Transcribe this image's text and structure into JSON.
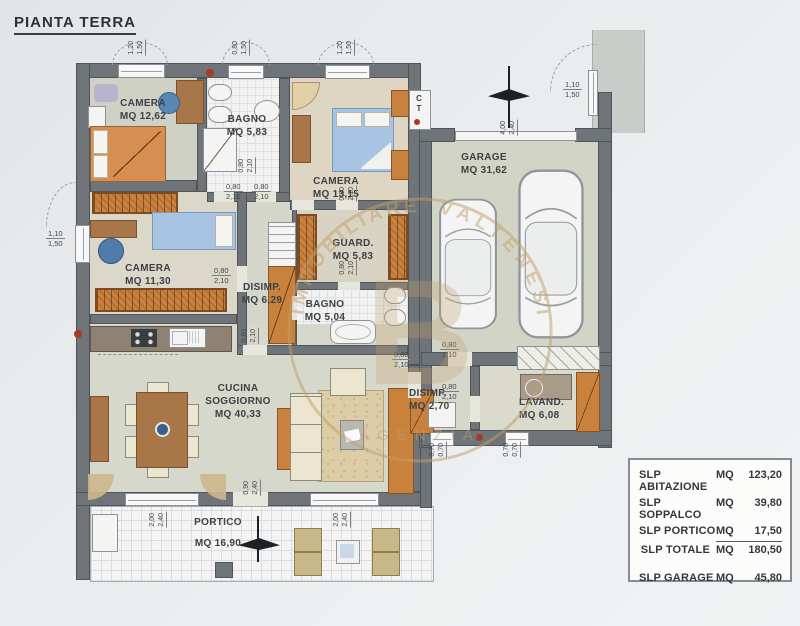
{
  "title": "PIANTA TERRA",
  "colors": {
    "wall": "#6f7478",
    "paper": "#e9ebec",
    "floor": "#d8d8ca",
    "furniture_orange": "#c8823e",
    "bed_blue": "#a9c3e2",
    "watermark_tan": "#c2a06c",
    "red_dot": "#a83a28"
  },
  "rooms": {
    "camera1": {
      "name": "CAMERA",
      "area": "MQ 12,62"
    },
    "bagno1": {
      "name": "BAGNO",
      "area": "MQ 5,83"
    },
    "camera2": {
      "name": "CAMERA",
      "area": "MQ 13,15"
    },
    "camera3": {
      "name": "CAMERA",
      "area": "MQ 11,30"
    },
    "guard": {
      "name": "GUARD.",
      "area": "MQ 5,83"
    },
    "disimp1": {
      "name": "DISIMP.",
      "area": "MQ 6,29"
    },
    "bagno2": {
      "name": "BAGNO",
      "area": "MQ 5,04"
    },
    "soggiorno": {
      "name1": "CUCINA",
      "name2": "SOGGIORNO",
      "area": "MQ 40,33"
    },
    "portico": {
      "name": "PORTICO",
      "area": "MQ 16,90"
    },
    "garage": {
      "name": "GARAGE",
      "area": "MQ 31,62"
    },
    "disimp2": {
      "name": "DISIMP.",
      "area": "MQ 2,70"
    },
    "lavand": {
      "name": "LAVAND.",
      "area": "MQ 6,08"
    }
  },
  "ct": {
    "c": "C",
    "t": "T"
  },
  "dims": [
    {
      "x": 127,
      "y": 40,
      "o": "v",
      "a": "1,20",
      "b": "1,50"
    },
    {
      "x": 231,
      "y": 40,
      "o": "v",
      "a": "0,80",
      "b": "1,50"
    },
    {
      "x": 336,
      "y": 40,
      "o": "v",
      "a": "1,20",
      "b": "1,50"
    },
    {
      "x": 499,
      "y": 120,
      "o": "v",
      "a": "4,00",
      "b": "2,40"
    },
    {
      "x": 237,
      "y": 158,
      "o": "v",
      "a": "0,80",
      "b": "2,10"
    },
    {
      "x": 338,
      "y": 186,
      "o": "v",
      "a": "0,80",
      "b": "2,10"
    },
    {
      "x": 338,
      "y": 260,
      "o": "v",
      "a": "0,80",
      "b": "2,10"
    },
    {
      "x": 240,
      "y": 328,
      "o": "v",
      "a": "0,80",
      "b": "2,10"
    },
    {
      "x": 242,
      "y": 480,
      "o": "v",
      "a": "0,90",
      "b": "2,40"
    },
    {
      "x": 148,
      "y": 512,
      "o": "v",
      "a": "2,00",
      "b": "2,40"
    },
    {
      "x": 332,
      "y": 512,
      "o": "v",
      "a": "2,00",
      "b": "2,40"
    },
    {
      "x": 428,
      "y": 442,
      "o": "v",
      "a": "0,70",
      "b": "0,70"
    },
    {
      "x": 502,
      "y": 442,
      "o": "v",
      "a": "0,70",
      "b": "0,70"
    },
    {
      "x": 46,
      "y": 229,
      "o": "h",
      "a": "1,10",
      "b": "1,50"
    },
    {
      "x": 563,
      "y": 80,
      "o": "h",
      "a": "1,10",
      "b": "1,50"
    },
    {
      "x": 224,
      "y": 182,
      "o": "h",
      "a": "0,80",
      "b": "2,10"
    },
    {
      "x": 252,
      "y": 182,
      "o": "h",
      "a": "0,80",
      "b": "2,10"
    },
    {
      "x": 212,
      "y": 266,
      "o": "h",
      "a": "0,80",
      "b": "2,10"
    },
    {
      "x": 392,
      "y": 350,
      "o": "h",
      "a": "0,80",
      "b": "2,10"
    },
    {
      "x": 440,
      "y": 340,
      "o": "h",
      "a": "0,80",
      "b": "2,10"
    },
    {
      "x": 440,
      "y": 382,
      "o": "h",
      "a": "0,80",
      "b": "2,10"
    }
  ],
  "watermark": {
    "arc_left": "IMMOBILIARE",
    "arc_right": "VALTENESI",
    "monogram": "B",
    "footer": "AGENZIA"
  },
  "slp": {
    "rows": [
      {
        "label": "SLP ABITAZIONE",
        "unit": "MQ",
        "value": "123,20"
      },
      {
        "label": "SLP SOPPALCO",
        "unit": "MQ",
        "value": "39,80"
      },
      {
        "label": "SLP PORTICO",
        "unit": "MQ",
        "value": "17,50"
      },
      {
        "label": "SLP TOTALE",
        "unit": "MQ",
        "value": "180,50"
      },
      {
        "label": "SLP GARAGE",
        "unit": "MQ",
        "value": "45,80"
      }
    ]
  }
}
